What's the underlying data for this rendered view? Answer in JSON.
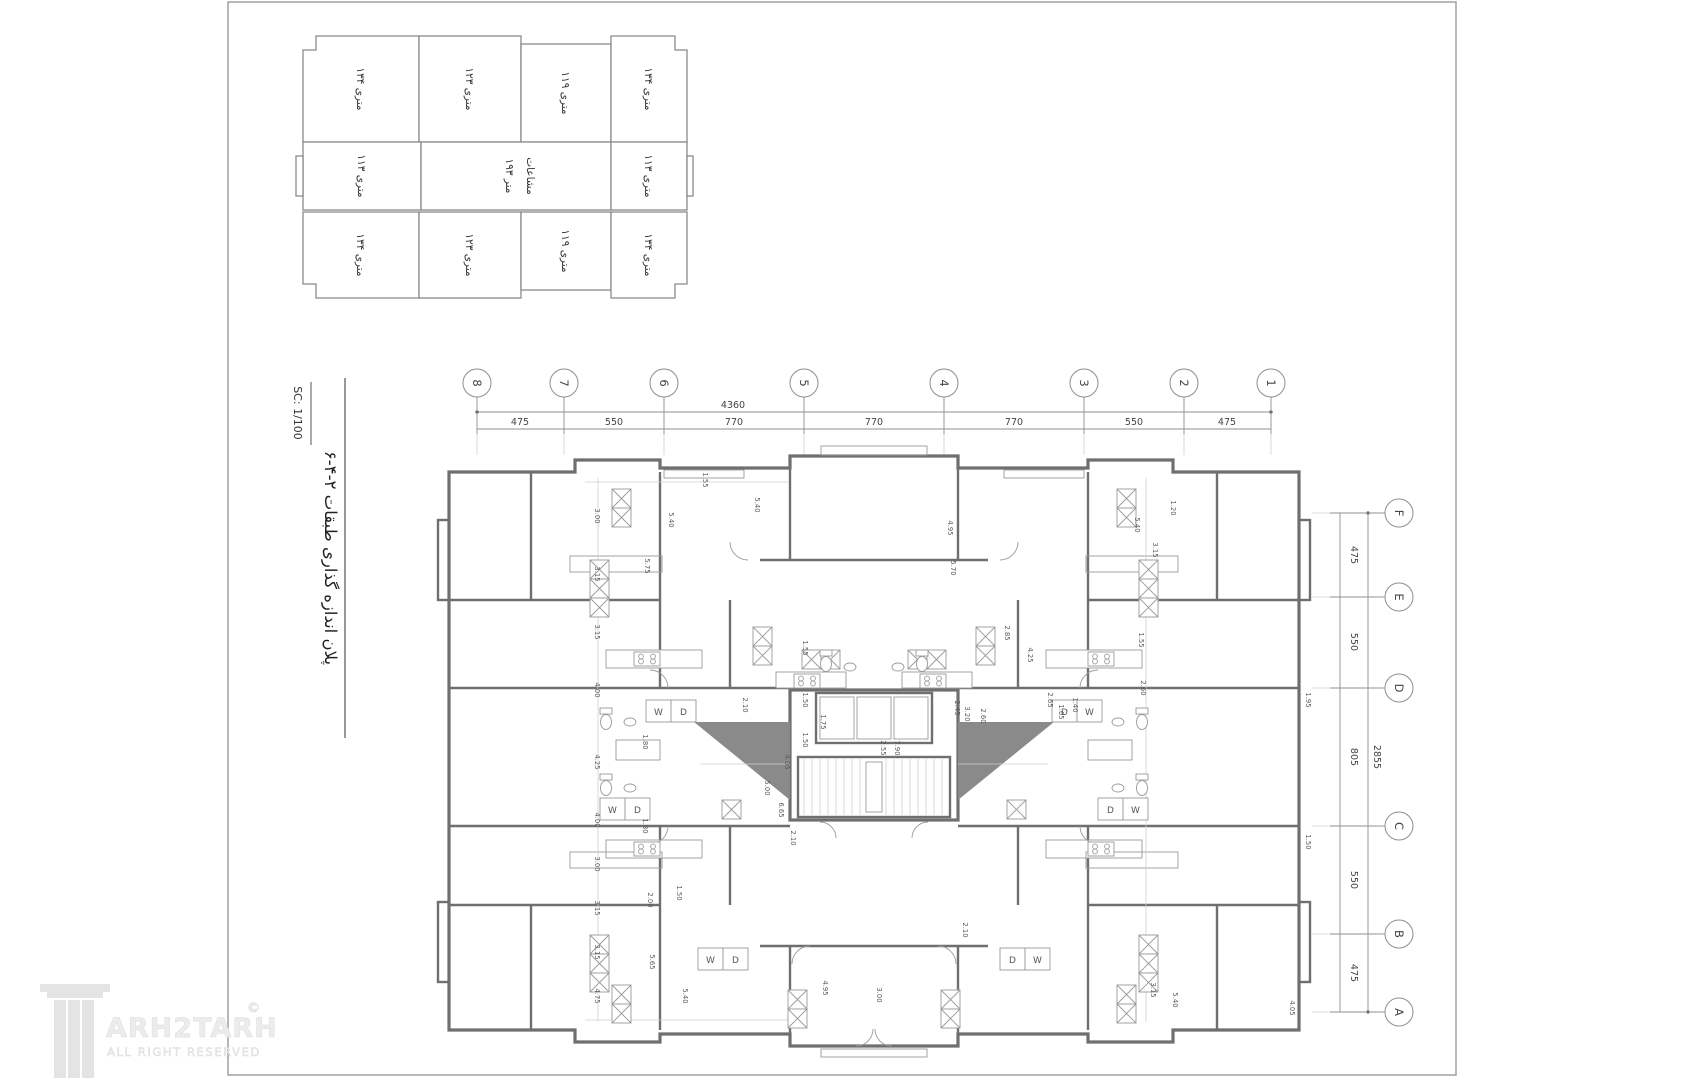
{
  "sheet": {
    "scale_label": "SC: 1/100",
    "title": "پلان اندازه گذاری طبقات ۲-۴-۶"
  },
  "key_plan": {
    "units": [
      {
        "label": "۱۳۴ متری",
        "x": 361,
        "y": 89
      },
      {
        "label": "۱۲۳ متری",
        "x": 470,
        "y": 89
      },
      {
        "label": "۱۱۹ متری",
        "x": 566,
        "y": 93
      },
      {
        "label": "۱۳۴ متری",
        "x": 649,
        "y": 89
      },
      {
        "label": "۱۱۳ متری",
        "x": 362,
        "y": 176
      },
      {
        "label": "۱۱۳ متری",
        "x": 649,
        "y": 176
      },
      {
        "label": "۱۳۴ متری",
        "x": 361,
        "y": 255
      },
      {
        "label": "۱۲۳ متری",
        "x": 470,
        "y": 255
      },
      {
        "label": "۱۱۹ متری",
        "x": 566,
        "y": 251
      },
      {
        "label": "۱۳۴ متری",
        "x": 649,
        "y": 255
      }
    ],
    "center_label": {
      "line1": "۱۹۳ متر",
      "line2": "مشاعات",
      "x1": 506,
      "x2": 527,
      "y": 176
    }
  },
  "grid": {
    "top": {
      "total": "4360",
      "bubbles": [
        {
          "n": "8",
          "x": 477
        },
        {
          "n": "7",
          "x": 564
        },
        {
          "n": "6",
          "x": 664
        },
        {
          "n": "5",
          "x": 804
        },
        {
          "n": "4",
          "x": 944
        },
        {
          "n": "3",
          "x": 1084
        },
        {
          "n": "2",
          "x": 1184
        },
        {
          "n": "1",
          "x": 1271
        }
      ],
      "segments": [
        {
          "t": "475",
          "x": 520
        },
        {
          "t": "550",
          "x": 614
        },
        {
          "t": "770",
          "x": 734
        },
        {
          "t": "770",
          "x": 874
        },
        {
          "t": "770",
          "x": 1014
        },
        {
          "t": "550",
          "x": 1134
        },
        {
          "t": "475",
          "x": 1227
        }
      ]
    },
    "right": {
      "total": "2855",
      "bubbles": [
        {
          "n": "F",
          "y": 513
        },
        {
          "n": "E",
          "y": 597
        },
        {
          "n": "D",
          "y": 688
        },
        {
          "n": "C",
          "y": 826
        },
        {
          "n": "B",
          "y": 934
        },
        {
          "n": "A",
          "y": 1012
        }
      ],
      "segments": [
        {
          "t": "475",
          "y": 555
        },
        {
          "t": "550",
          "y": 642
        },
        {
          "t": "805",
          "y": 757
        },
        {
          "t": "550",
          "y": 880
        },
        {
          "t": "475",
          "y": 973
        }
      ]
    }
  },
  "plan": {
    "wd_units": [
      {
        "a": "W",
        "b": "D",
        "x": 646,
        "y": 700
      },
      {
        "a": "D",
        "b": "W",
        "x": 1052,
        "y": 700
      },
      {
        "a": "W",
        "b": "D",
        "x": 600,
        "y": 798
      },
      {
        "a": "D",
        "b": "W",
        "x": 1098,
        "y": 798
      },
      {
        "a": "W",
        "b": "D",
        "x": 698,
        "y": 948
      },
      {
        "a": "D",
        "b": "W",
        "x": 1000,
        "y": 948
      }
    ],
    "dims": [
      {
        "t": "3.00",
        "x": 598,
        "y": 516
      },
      {
        "t": "3.15",
        "x": 598,
        "y": 574
      },
      {
        "t": "3.15",
        "x": 598,
        "y": 632
      },
      {
        "t": "4.00",
        "x": 598,
        "y": 690
      },
      {
        "t": "4.25",
        "x": 598,
        "y": 762
      },
      {
        "t": "4.00",
        "x": 598,
        "y": 820
      },
      {
        "t": "3.00",
        "x": 598,
        "y": 864
      },
      {
        "t": "3.15",
        "x": 598,
        "y": 908
      },
      {
        "t": "3.15",
        "x": 598,
        "y": 952
      },
      {
        "t": "4.75",
        "x": 598,
        "y": 996
      },
      {
        "t": "5.40",
        "x": 672,
        "y": 520
      },
      {
        "t": "5.75",
        "x": 648,
        "y": 566
      },
      {
        "t": "5.40",
        "x": 758,
        "y": 505
      },
      {
        "t": "1.55",
        "x": 706,
        "y": 480
      },
      {
        "t": "1.80",
        "x": 646,
        "y": 742
      },
      {
        "t": "1.80",
        "x": 646,
        "y": 826
      },
      {
        "t": "2.00",
        "x": 651,
        "y": 900
      },
      {
        "t": "1.50",
        "x": 680,
        "y": 893
      },
      {
        "t": "5.65",
        "x": 653,
        "y": 962
      },
      {
        "t": "5.40",
        "x": 686,
        "y": 996
      },
      {
        "t": "2.10",
        "x": 746,
        "y": 705
      },
      {
        "t": "1.55",
        "x": 806,
        "y": 648
      },
      {
        "t": "1.50",
        "x": 806,
        "y": 700
      },
      {
        "t": "1.50",
        "x": 806,
        "y": 740
      },
      {
        "t": "2.55",
        "x": 884,
        "y": 748
      },
      {
        "t": "7.90",
        "x": 898,
        "y": 748
      },
      {
        "t": "4.05",
        "x": 788,
        "y": 762
      },
      {
        "t": "5.00",
        "x": 768,
        "y": 788
      },
      {
        "t": "6.65",
        "x": 782,
        "y": 810
      },
      {
        "t": "2.10",
        "x": 794,
        "y": 838
      },
      {
        "t": "1.75",
        "x": 824,
        "y": 722
      },
      {
        "t": "2.45",
        "x": 958,
        "y": 708
      },
      {
        "t": "3.20",
        "x": 968,
        "y": 714
      },
      {
        "t": "2.60",
        "x": 984,
        "y": 716
      },
      {
        "t": "2.65",
        "x": 1051,
        "y": 700
      },
      {
        "t": "1.65",
        "x": 1062,
        "y": 712
      },
      {
        "t": "1.40",
        "x": 1076,
        "y": 705
      },
      {
        "t": "2.85",
        "x": 1008,
        "y": 633
      },
      {
        "t": "4.25",
        "x": 1031,
        "y": 655
      },
      {
        "t": "4.95",
        "x": 951,
        "y": 528
      },
      {
        "t": "5.70",
        "x": 954,
        "y": 568
      },
      {
        "t": "5.40",
        "x": 1138,
        "y": 525
      },
      {
        "t": "3.15",
        "x": 1156,
        "y": 550
      },
      {
        "t": "1.20",
        "x": 1174,
        "y": 508
      },
      {
        "t": "1.55",
        "x": 1142,
        "y": 640
      },
      {
        "t": "2.60",
        "x": 1144,
        "y": 688
      },
      {
        "t": "1.95",
        "x": 1309,
        "y": 700
      },
      {
        "t": "1.50",
        "x": 1309,
        "y": 842
      },
      {
        "t": "2.10",
        "x": 966,
        "y": 930
      },
      {
        "t": "3.15",
        "x": 1154,
        "y": 990
      },
      {
        "t": "5.40",
        "x": 1176,
        "y": 1000
      },
      {
        "t": "4.95",
        "x": 826,
        "y": 988
      },
      {
        "t": "3.00",
        "x": 880,
        "y": 995
      },
      {
        "t": "4.05",
        "x": 1293,
        "y": 1008
      }
    ]
  },
  "watermark": {
    "brand": "ARH2TARH",
    "mark": "©",
    "tagline": "ALL RIGHT RESERVED"
  }
}
